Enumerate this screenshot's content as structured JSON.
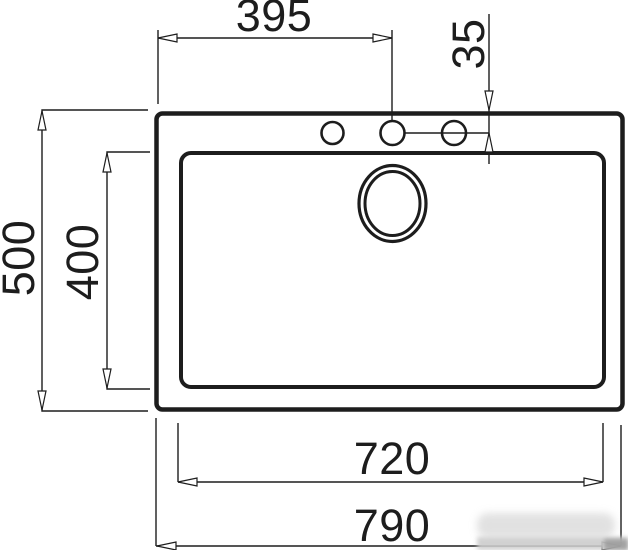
{
  "drawing": {
    "title": "sink-top-view-technical-drawing",
    "units_implied": "mm",
    "labels": {
      "tap_hole_offset_x": "395",
      "tap_hole_offset_y": "35",
      "overall_depth": "500",
      "bowl_depth": "400",
      "bowl_width": "720",
      "overall_width": "790"
    },
    "features": {
      "outer_outline": "sink overall rectangle",
      "inner_outline": "bowl rectangle",
      "tap_holes": 3,
      "drain": "double-ring circle"
    },
    "colors": {
      "line": "#1d1d1d",
      "background": "#ffffff",
      "watermark": "#c9c9c9"
    }
  }
}
